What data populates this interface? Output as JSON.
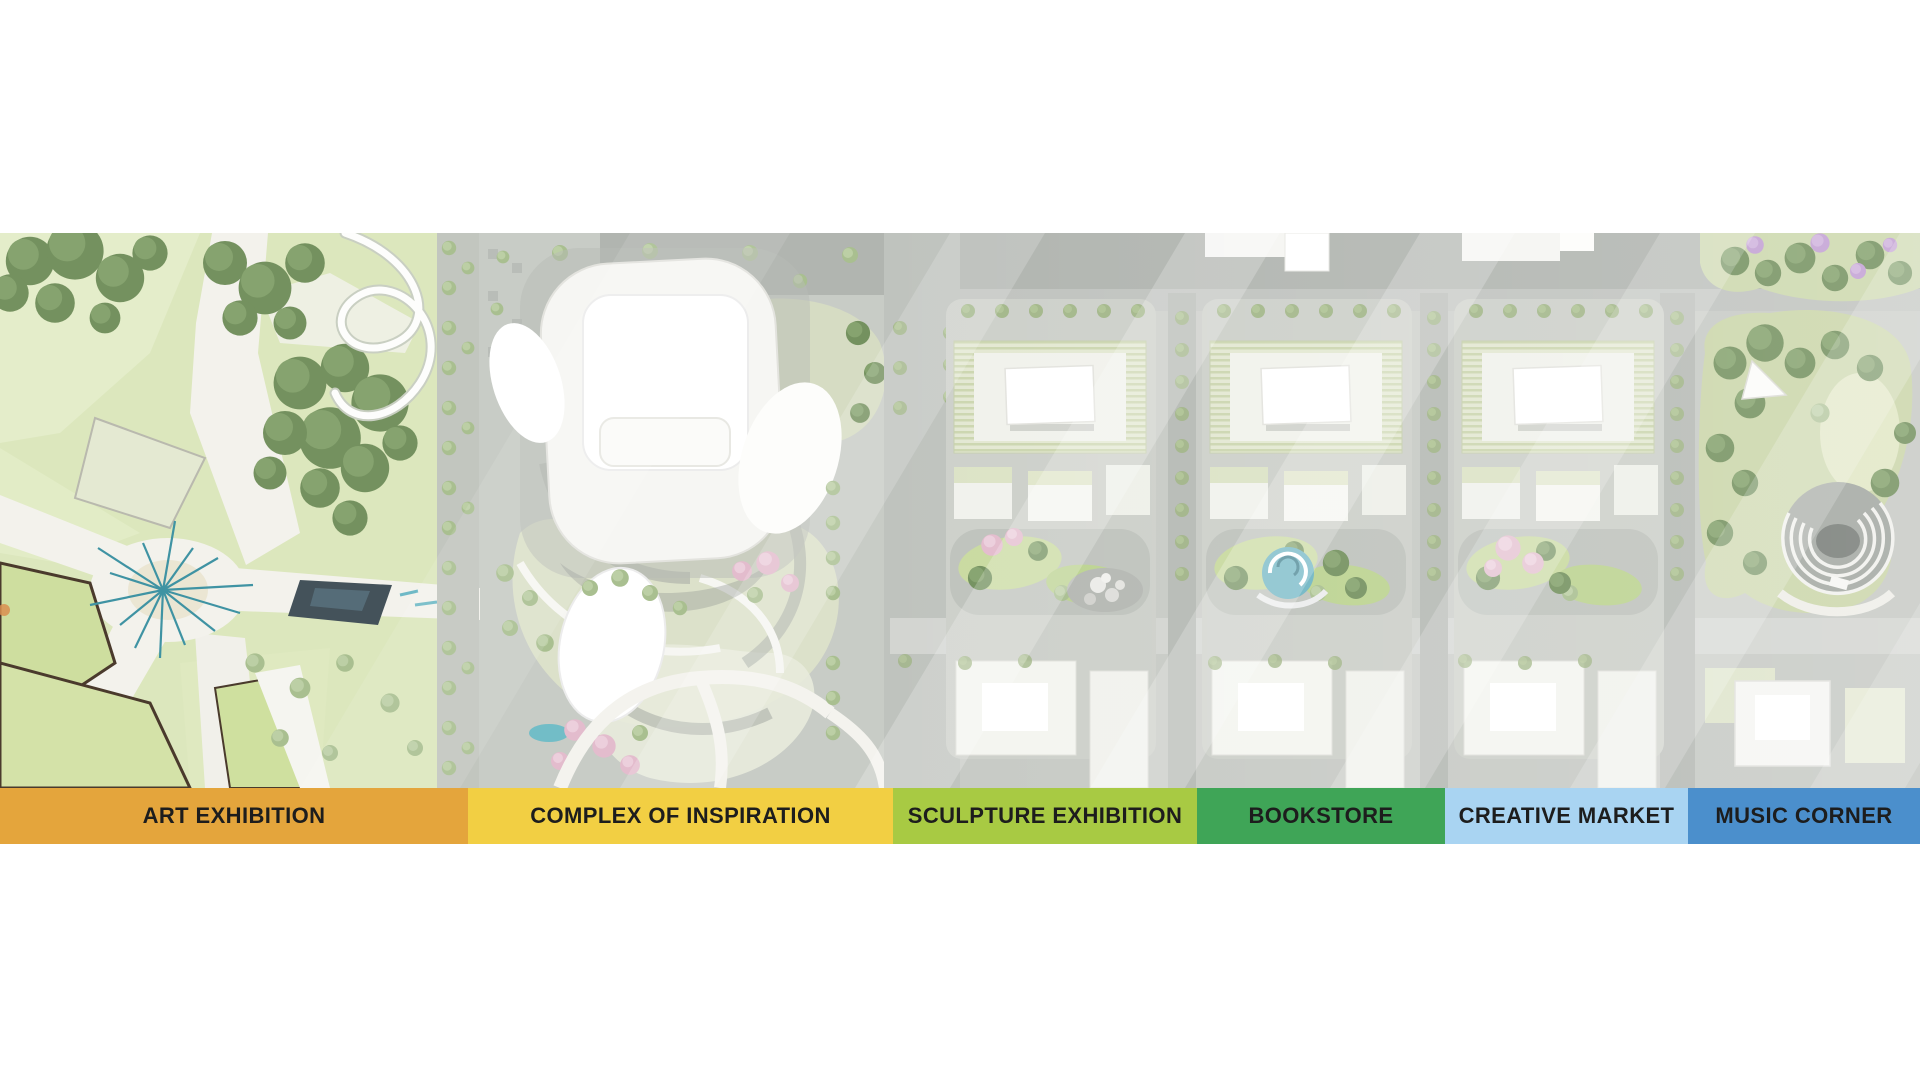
{
  "legend": {
    "items": [
      {
        "label": "ART EXHIBITION",
        "color": "#E4A53C"
      },
      {
        "label": "COMPLEX OF INSPIRATION",
        "color": "#F2CF43"
      },
      {
        "label": "SCULPTURE EXHIBITION",
        "color": "#A8CA43"
      },
      {
        "label": "BOOKSTORE",
        "color": "#3FA557"
      },
      {
        "label": "CREATIVE MARKET",
        "color": "#A9D4F2"
      },
      {
        "label": "MUSIC CORNER",
        "color": "#4B8FCC"
      }
    ],
    "label_color": "#1D1D1D"
  }
}
